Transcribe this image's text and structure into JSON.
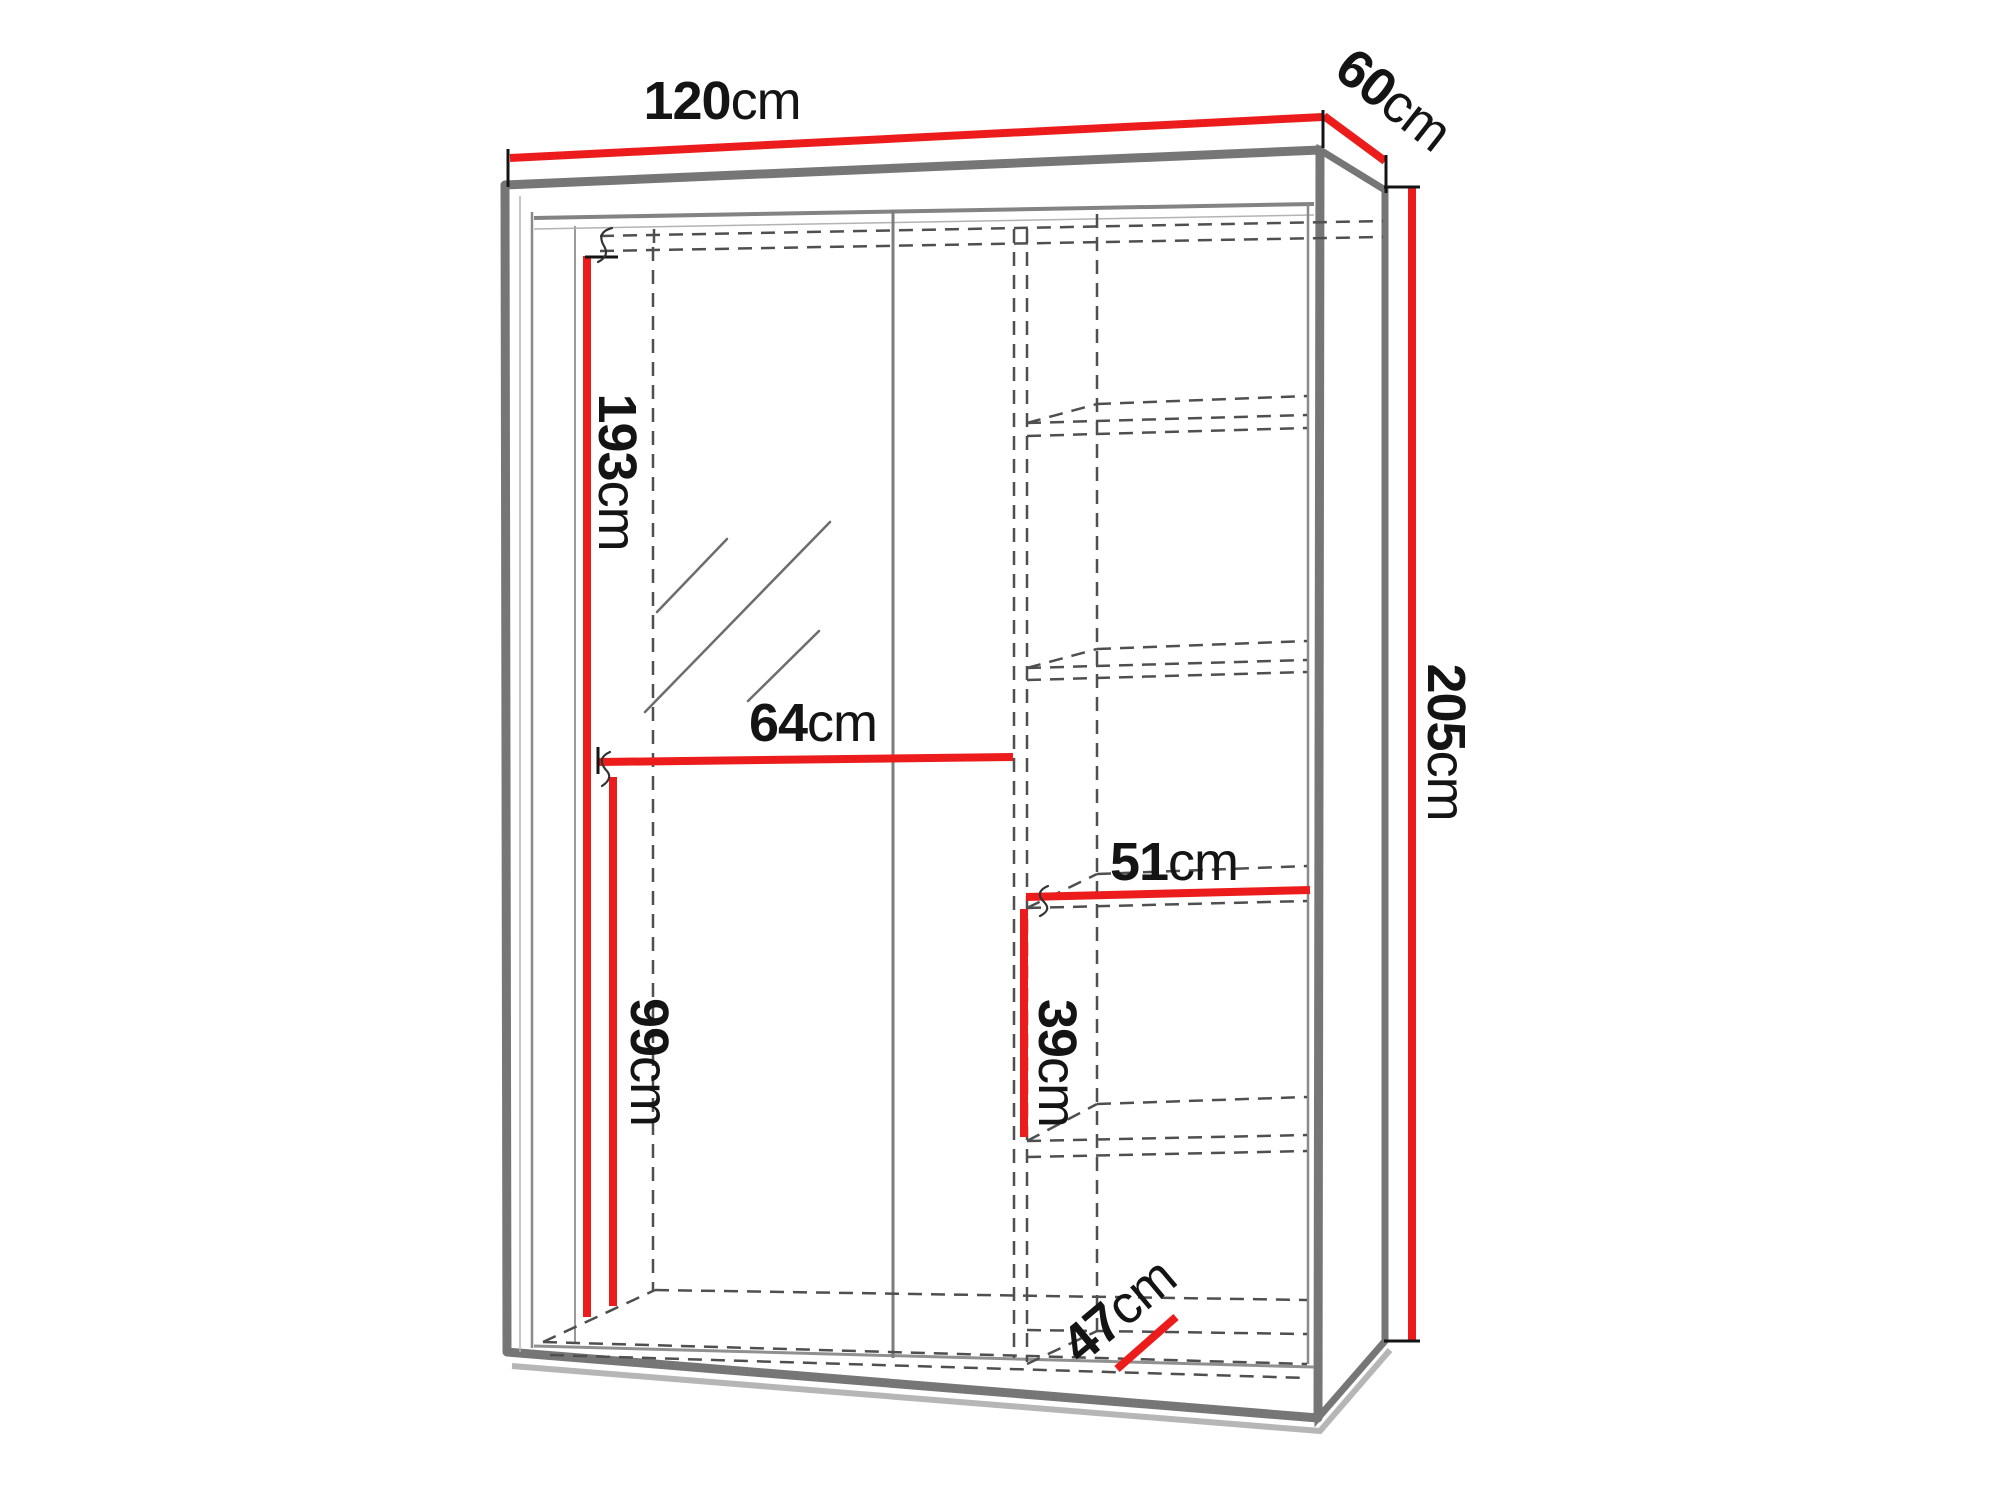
{
  "dimensions": {
    "width": {
      "value": "120",
      "unit": "cm"
    },
    "depth": {
      "value": "60",
      "unit": "cm"
    },
    "height": {
      "value": "205",
      "unit": "cm"
    },
    "interior_height": {
      "value": "193",
      "unit": "cm"
    },
    "hanging_width": {
      "value": "64",
      "unit": "cm"
    },
    "lower_height": {
      "value": "99",
      "unit": "cm"
    },
    "shelf_width": {
      "value": "51",
      "unit": "cm"
    },
    "shelf_spacing": {
      "value": "39",
      "unit": "cm"
    },
    "interior_depth": {
      "value": "47",
      "unit": "cm"
    }
  },
  "colors": {
    "dimension_red": "#ed1c1c",
    "frame_gray": "#767676",
    "dash_gray": "#4f4f4f",
    "text_black": "#141414",
    "background": "#ffffff"
  }
}
